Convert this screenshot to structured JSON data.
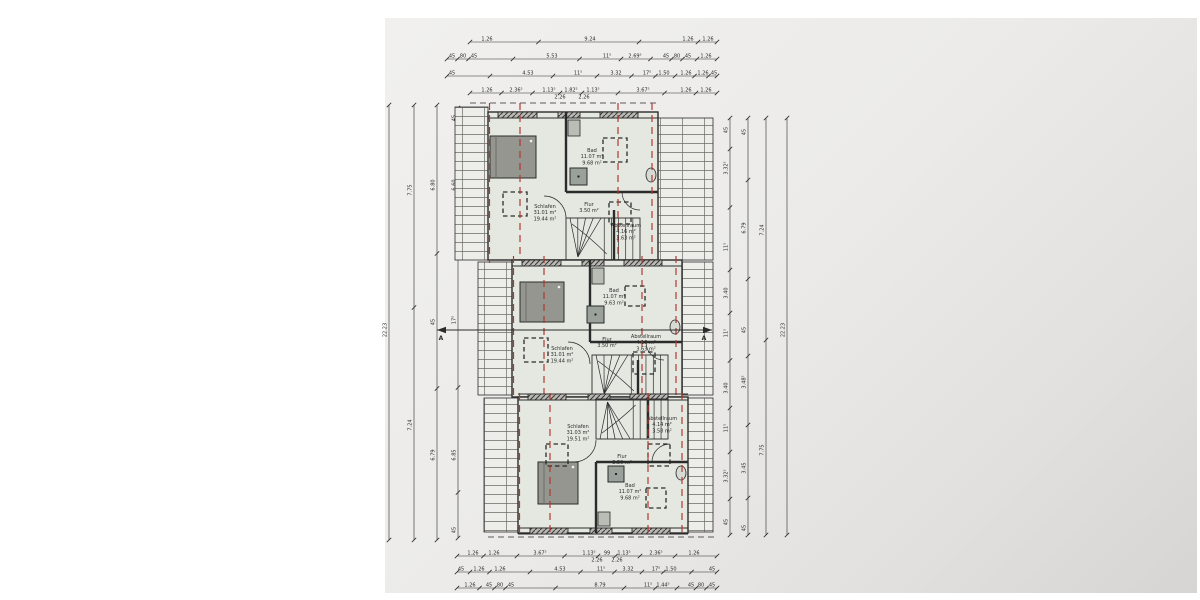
{
  "colors": {
    "ink": "#2b2b2b",
    "wall_dark": "#2e2e2e",
    "red_dash": "#b03a2e",
    "room_fill": "#e5e8e1",
    "roof_fill": "#ededea",
    "bed_fill": "#95968f",
    "shower_fill": "#9aa09a",
    "paper": "#eeedeb"
  },
  "section": {
    "label": "A"
  },
  "units": [
    {
      "id": "top",
      "schlafen": {
        "name": "Schlafen",
        "a1": "31.01 m²",
        "a2": "19.44 m²"
      },
      "bad": {
        "name": "Bad",
        "a1": "11.07 m²",
        "a2": "9.68 m²"
      },
      "flur": {
        "name": "Flur",
        "a1": "3.50 m²"
      },
      "abstellraum": {
        "name": "Abstellraum",
        "a1": "4.16 m²",
        "a2": "3.63 m²"
      }
    },
    {
      "id": "middle",
      "schlafen": {
        "name": "Schlafen",
        "a1": "31.01 m²",
        "a2": "19.44 m²"
      },
      "bad": {
        "name": "Bad",
        "a1": "11.07 m²",
        "a2": "9.63 m²"
      },
      "flur": {
        "name": "Flur",
        "a1": "3.50 m²"
      },
      "abstellraum": {
        "name": "Abstellraum",
        "a1": "4.16 m²",
        "a2": "3.63 m²"
      }
    },
    {
      "id": "bottom",
      "schlafen": {
        "name": "Schlafen",
        "a1": "31.03 m²",
        "a2": "19.51 m²"
      },
      "bad": {
        "name": "Bad",
        "a1": "11.07 m²",
        "a2": "9.68 m²"
      },
      "flur": {
        "name": "Flur",
        "a1": "3.50 m²"
      },
      "abstellraum": {
        "name": "Abstellraum",
        "a1": "4.14 m²",
        "a2": "3.58 m²"
      }
    }
  ],
  "dimensions": {
    "top_rows": [
      {
        "y": 42,
        "x1": 470,
        "x2": 717,
        "labels": [
          {
            "t": "1.26",
            "x": 487
          },
          {
            "t": "9.24",
            "x": 590
          },
          {
            "t": "1.26",
            "x": 688
          },
          {
            "t": "1.26",
            "x": 708
          }
        ]
      },
      {
        "y": 59,
        "x1": 447,
        "x2": 717,
        "labels": [
          {
            "t": "45",
            "x": 452
          },
          {
            "t": "80",
            "x": 463
          },
          {
            "t": "45",
            "x": 474
          },
          {
            "t": "5.53",
            "x": 552
          },
          {
            "t": "11⁵",
            "x": 607
          },
          {
            "t": "2.69⁵",
            "x": 635
          },
          {
            "t": "45",
            "x": 666
          },
          {
            "t": "80",
            "x": 677
          },
          {
            "t": "45",
            "x": 688
          },
          {
            "t": "1.26",
            "x": 706
          }
        ]
      },
      {
        "y": 76,
        "x1": 447,
        "x2": 717,
        "labels": [
          {
            "t": "45",
            "x": 452
          },
          {
            "t": "4.53",
            "x": 528
          },
          {
            "t": "11⁵",
            "x": 578
          },
          {
            "t": "3.32",
            "x": 616
          },
          {
            "t": "17⁵",
            "x": 647
          },
          {
            "t": "1.50",
            "x": 664
          },
          {
            "t": "1.26",
            "x": 686
          },
          {
            "t": "1.26",
            "x": 703
          },
          {
            "t": "45",
            "x": 714
          }
        ]
      },
      {
        "y": 93,
        "x1": 470,
        "x2": 717,
        "labels": [
          {
            "t": "1.26",
            "x": 487
          },
          {
            "t": "2.36⁵",
            "x": 516
          },
          {
            "t": "1.13⁵",
            "x": 549
          },
          {
            "t": "1.82⁵",
            "x": 571
          },
          {
            "t": "1.13⁵",
            "x": 593
          },
          {
            "t": "3.67⁵",
            "x": 643
          },
          {
            "t": "1.26",
            "x": 686
          },
          {
            "t": "1.26",
            "x": 706
          }
        ]
      },
      {
        "y": 100,
        "line": false,
        "labels": [
          {
            "t": "2.26",
            "x": 560
          },
          {
            "t": "2.26",
            "x": 584
          }
        ]
      }
    ],
    "bottom_rows": [
      {
        "y": 556,
        "x1": 457,
        "x2": 717,
        "labels": [
          {
            "t": "1.26",
            "x": 473
          },
          {
            "t": "1.26",
            "x": 494
          },
          {
            "t": "3.67⁵",
            "x": 540
          },
          {
            "t": "1.13⁵",
            "x": 589
          },
          {
            "t": "99",
            "x": 607
          },
          {
            "t": "1.13⁵",
            "x": 624
          },
          {
            "t": "2.36⁵",
            "x": 656
          },
          {
            "t": "1.26",
            "x": 694
          }
        ]
      },
      {
        "y": 563,
        "line": false,
        "labels": [
          {
            "t": "2.26",
            "x": 597
          },
          {
            "t": "2.26",
            "x": 617
          }
        ]
      },
      {
        "y": 572,
        "x1": 457,
        "x2": 717,
        "labels": [
          {
            "t": "45",
            "x": 461
          },
          {
            "t": "1.26",
            "x": 479
          },
          {
            "t": "1.26",
            "x": 500
          },
          {
            "t": "4.53",
            "x": 560
          },
          {
            "t": "11⁵",
            "x": 601
          },
          {
            "t": "3.32",
            "x": 628
          },
          {
            "t": "17⁵",
            "x": 656
          },
          {
            "t": "1.50",
            "x": 671
          },
          {
            "t": "45",
            "x": 712
          }
        ]
      },
      {
        "y": 588,
        "x1": 457,
        "x2": 717,
        "labels": [
          {
            "t": "1.26",
            "x": 470
          },
          {
            "t": "45",
            "x": 489
          },
          {
            "t": "80",
            "x": 500
          },
          {
            "t": "45",
            "x": 511
          },
          {
            "t": "8.79",
            "x": 600
          },
          {
            "t": "11⁵",
            "x": 648
          },
          {
            "t": "1.44⁵",
            "x": 663
          },
          {
            "t": "45",
            "x": 691
          },
          {
            "t": "80",
            "x": 701
          },
          {
            "t": "45",
            "x": 712
          }
        ]
      }
    ],
    "left_cols": [
      {
        "x": 389,
        "y1": 105,
        "y2": 540,
        "labels": [
          {
            "t": "22.23",
            "y": 330
          }
        ]
      },
      {
        "x": 414,
        "y1": 105,
        "y2": 540,
        "labels": [
          {
            "t": "7.75",
            "y": 190
          },
          {
            "t": "7.24",
            "y": 425
          }
        ]
      },
      {
        "x": 437,
        "y1": 105,
        "y2": 540,
        "labels": [
          {
            "t": "6.80",
            "y": 185
          },
          {
            "t": "45",
            "y": 322
          },
          {
            "t": "6.79",
            "y": 455
          }
        ]
      },
      {
        "x": 458,
        "y1": 108,
        "y2": 538,
        "labels": [
          {
            "t": "45",
            "y": 118
          },
          {
            "t": "6.60",
            "y": 185
          },
          {
            "t": "17⁵",
            "y": 320
          },
          {
            "t": "6.85",
            "y": 455
          },
          {
            "t": "45",
            "y": 530
          }
        ]
      }
    ],
    "right_cols": [
      {
        "x": 730,
        "y1": 118,
        "y2": 535,
        "labels": [
          {
            "t": "45",
            "y": 130
          },
          {
            "t": "3.32⁵",
            "y": 168
          },
          {
            "t": "11⁵",
            "y": 247
          },
          {
            "t": "3.40",
            "y": 293
          },
          {
            "t": "11⁵",
            "y": 333
          },
          {
            "t": "3.40",
            "y": 388
          },
          {
            "t": "11⁵",
            "y": 428
          },
          {
            "t": "3.32⁵",
            "y": 476
          },
          {
            "t": "45",
            "y": 522
          }
        ]
      },
      {
        "x": 748,
        "y1": 118,
        "y2": 535,
        "labels": [
          {
            "t": "45",
            "y": 132
          },
          {
            "t": "6.79",
            "y": 228
          },
          {
            "t": "45",
            "y": 330
          },
          {
            "t": "3.48⁵",
            "y": 382
          },
          {
            "t": "3.45",
            "y": 468
          },
          {
            "t": "45",
            "y": 528
          }
        ]
      },
      {
        "x": 766,
        "y1": 118,
        "y2": 535,
        "labels": [
          {
            "t": "7.24",
            "y": 230
          },
          {
            "t": "7.75",
            "y": 450
          }
        ]
      },
      {
        "x": 787,
        "y1": 118,
        "y2": 535,
        "labels": [
          {
            "t": "22.23",
            "y": 330
          }
        ]
      }
    ]
  }
}
